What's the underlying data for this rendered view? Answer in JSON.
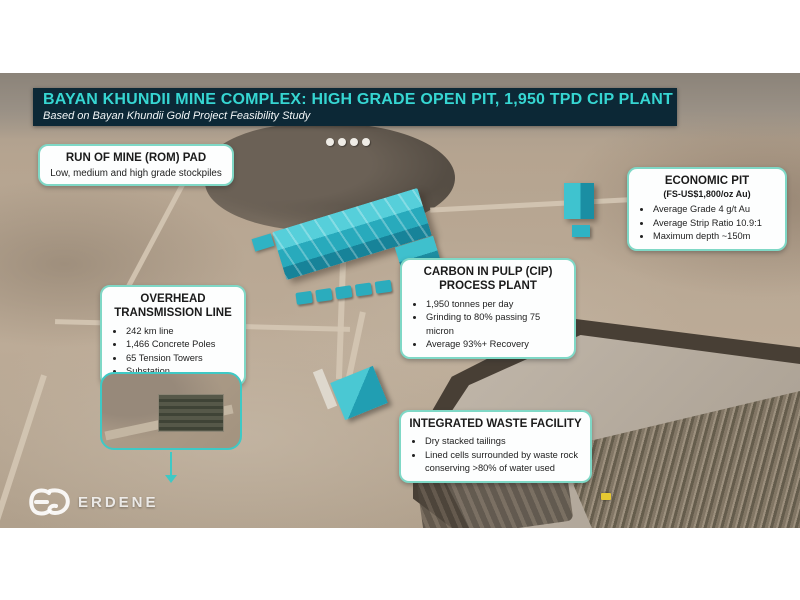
{
  "slide": {
    "title": "BAYAN KHUNDII MINE COMPLEX: HIGH GRADE OPEN PIT, 1,950 TPD CIP PLANT",
    "subtitle": "Based on Bayan Khundii Gold Project Feasibility Study"
  },
  "callouts": {
    "rom_pad": {
      "title": "RUN OF MINE (ROM) PAD",
      "description": "Low, medium and high grade stockpiles"
    },
    "economic_pit": {
      "title": "ECONOMIC PIT",
      "subtitle": "(FS-US$1,800/oz Au)",
      "bullets": [
        "Average Grade 4 g/t Au",
        "Average Strip Ratio 10.9:1",
        "Maximum depth ~150m"
      ]
    },
    "cip_plant": {
      "title": "CARBON IN PULP (CIP) PROCESS PLANT",
      "bullets": [
        "1,950 tonnes per day",
        "Grinding to 80% passing 75 micron",
        "Average 93%+ Recovery"
      ]
    },
    "transmission_line": {
      "title": "OVERHEAD TRANSMISSION LINE",
      "bullets": [
        "242 km line",
        "1,466 Concrete Poles",
        "65 Tension Towers",
        "Substation"
      ]
    },
    "waste_facility": {
      "title": "INTEGRATED WASTE FACILITY",
      "bullets": [
        "Dry stacked tailings",
        "Lined cells surrounded by waste rock conserving >80% of water used"
      ]
    }
  },
  "logo": {
    "text": "ERDENE"
  },
  "colors": {
    "banner_bg": "#0c2836",
    "banner_title": "#36d6d2",
    "callout_border": "#7fd8c6",
    "highlight_teal": "#3ec9c5",
    "building_teal": "#2eb6c5"
  }
}
